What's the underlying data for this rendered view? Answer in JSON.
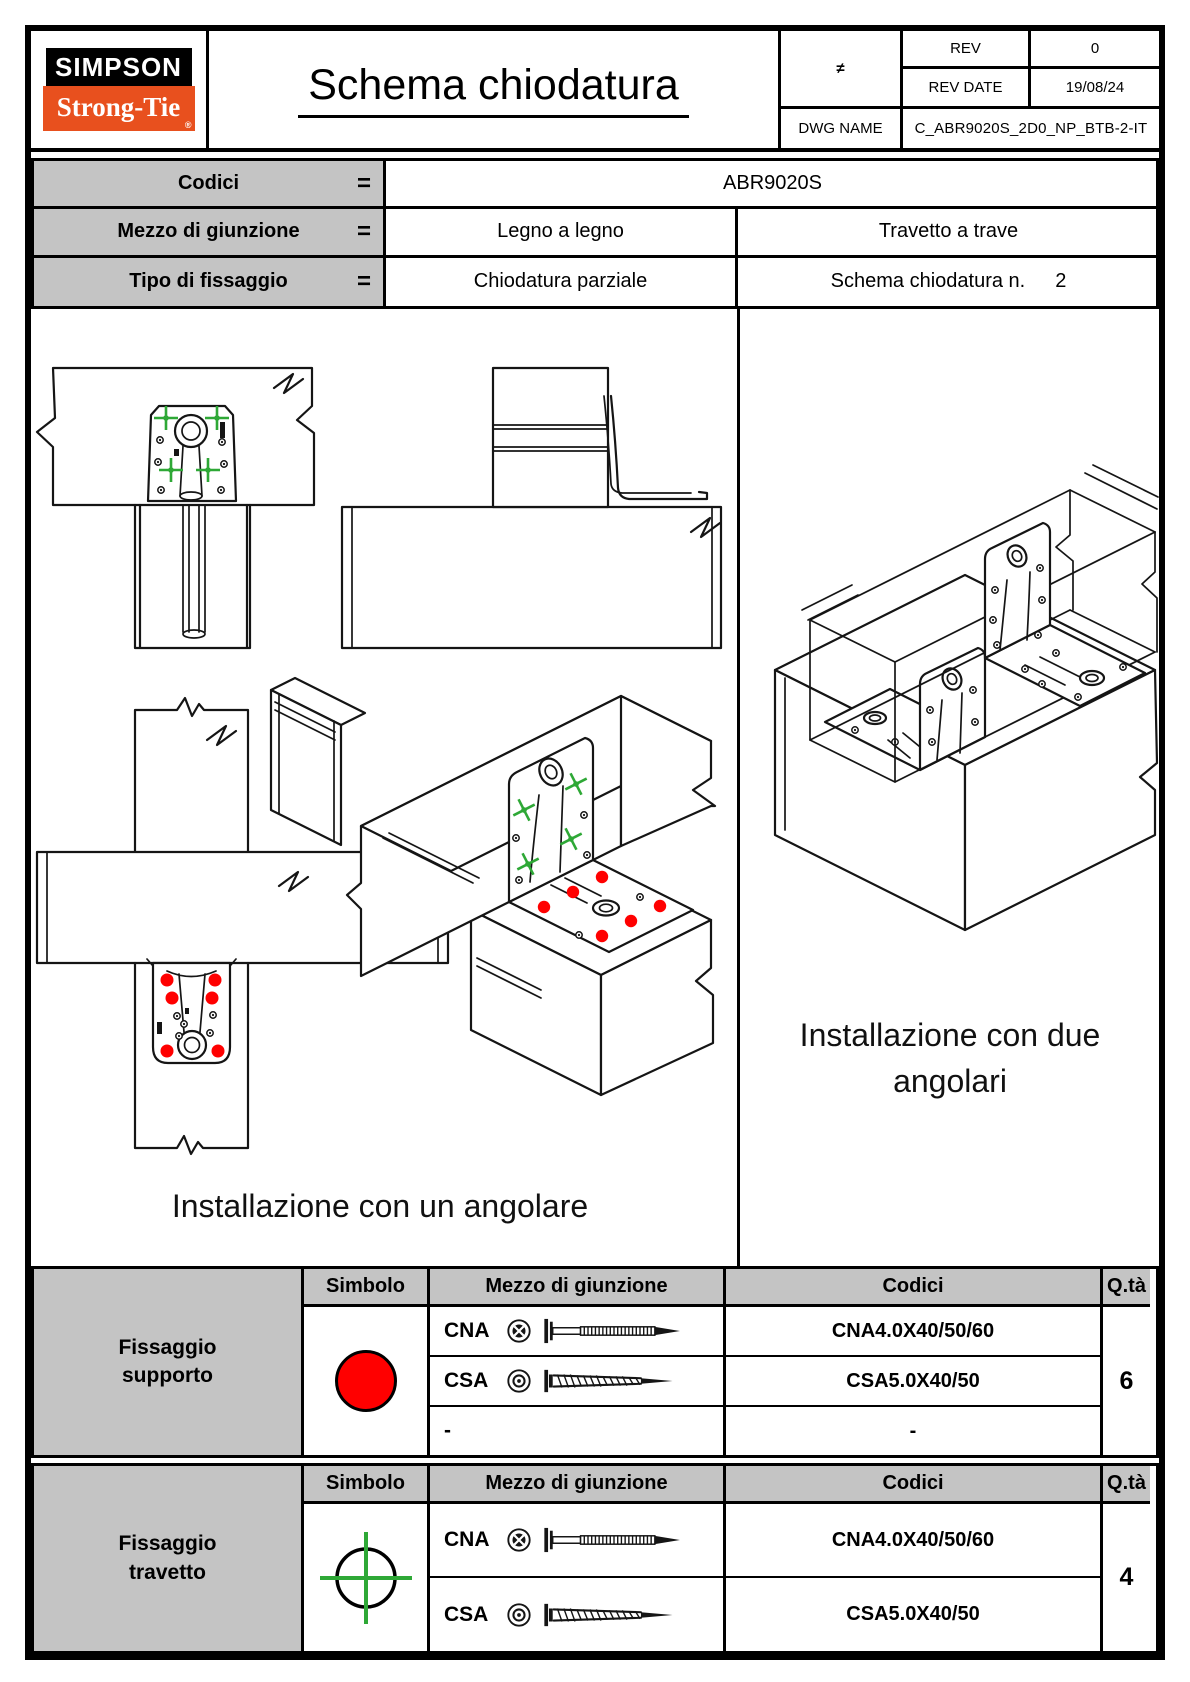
{
  "colors": {
    "accent_orange": "#E8501E",
    "fixing_support_red": "#FF0000",
    "fixing_joist_green": "#2EA836",
    "cell_gray": "#C4C4C4"
  },
  "header": {
    "logo_line1": "SIMPSON",
    "logo_line2": "Strong-Tie",
    "logo_reg": "®",
    "title": "Schema chiodatura",
    "projection_symbol": "≠",
    "rev_label": "REV",
    "rev_value": "0",
    "rev_date_label": "REV DATE",
    "rev_date_value": "19/08/24",
    "dwg_name_label": "DWG NAME",
    "dwg_name_value": "C_ABR9020S_2D0_NP_BTB-2-IT"
  },
  "info": {
    "rows": [
      {
        "label": "Codici",
        "eq": "=",
        "value": "ABR9020S"
      },
      {
        "label": "Mezzo di giunzione",
        "eq": "=",
        "value_left": "Legno a legno",
        "value_right": "Travetto a trave"
      },
      {
        "label": "Tipo di fissaggio",
        "eq": "=",
        "value_left": "Chiodatura parziale",
        "value_right": "Schema chiodatura n.",
        "schema_number": "2"
      }
    ]
  },
  "drawings": {
    "left_caption": "Installazione con un angolare",
    "right_caption_line1": "Installazione con due",
    "right_caption_line2": "angolari"
  },
  "fixing_tables": [
    {
      "group_label": "Fissaggio supporto",
      "headers": {
        "symbol": "Simbolo",
        "fastener": "Mezzo di giunzione",
        "codes": "Codici",
        "qty": "Q.tà"
      },
      "symbol": "red-filled-circle",
      "rows": [
        {
          "name": "CNA",
          "fastener_icon": "annular-ring-nail",
          "code": "CNA4.0X40/50/60"
        },
        {
          "name": "CSA",
          "fastener_icon": "connector-screw",
          "code": "CSA5.0X40/50"
        },
        {
          "name": "-",
          "fastener_icon": "none",
          "code": "-"
        }
      ],
      "qty": "6"
    },
    {
      "group_label": "Fissaggio travetto",
      "headers": {
        "symbol": "Simbolo",
        "fastener": "Mezzo di giunzione",
        "codes": "Codici",
        "qty": "Q.tà"
      },
      "symbol": "green-crosshair-circle",
      "rows": [
        {
          "name": "CNA",
          "fastener_icon": "annular-ring-nail",
          "code": "CNA4.0X40/50/60"
        },
        {
          "name": "CSA",
          "fastener_icon": "connector-screw",
          "code": "CSA5.0X40/50"
        }
      ],
      "qty": "4"
    }
  ]
}
